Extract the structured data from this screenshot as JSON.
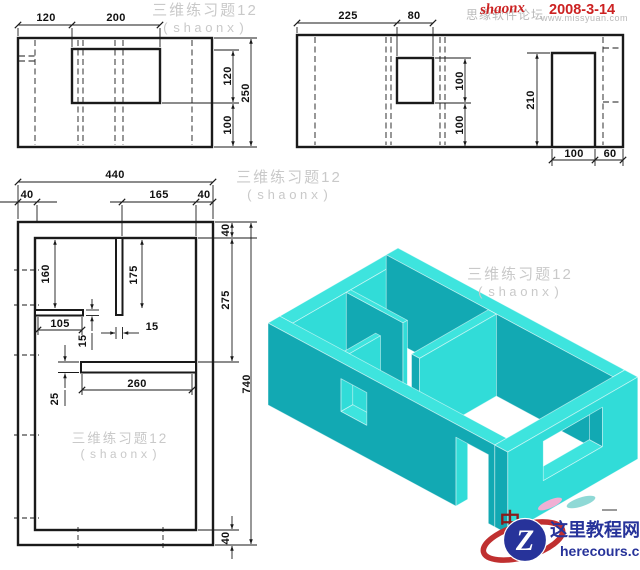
{
  "watermark": {
    "title": "三维练习题12",
    "author": "(shaonx)"
  },
  "banner": {
    "forum_text": "思缘软件论坛",
    "forum_url": "www.missyuan.com",
    "signature": "shaonx",
    "date": "2008-3-14"
  },
  "logo": {
    "letter": "Z",
    "site_name": "这里教程网",
    "site_domain": "herecours.com",
    "stray_char": "中"
  },
  "colors": {
    "iso_top": "#3ee4de",
    "iso_south": "#31dcd8",
    "iso_west": "#12a9b3",
    "iso_shadow": "#0e8f9c",
    "watermark_gray": "#c9c9c9",
    "accent_red": "#cc2222",
    "logo_navy": "#27339a",
    "logo_red": "#c03030"
  },
  "views": {
    "front": {
      "dims": {
        "seg_left": "120",
        "seg_window": "200",
        "window_height": "120",
        "below_window": "100",
        "total_height": "250"
      }
    },
    "side": {
      "dims": {
        "seg_left": "225",
        "window_width": "80",
        "window_height": "100",
        "below_window": "100",
        "door_height": "210",
        "door_width": "100",
        "seg_right": "60"
      }
    },
    "plan": {
      "dims": {
        "total_width": "440",
        "wall_left": "40",
        "seg_mid": "165",
        "wall_right": "40",
        "wall_top": "40",
        "room_right": "275",
        "wall_bottom": "40",
        "total_height": "740",
        "room_left": "160",
        "partition_len": "175",
        "stub_len": "105",
        "partition_thk": "15",
        "stub_thk": "15",
        "wall_thk": "25",
        "opening": "260"
      }
    }
  }
}
